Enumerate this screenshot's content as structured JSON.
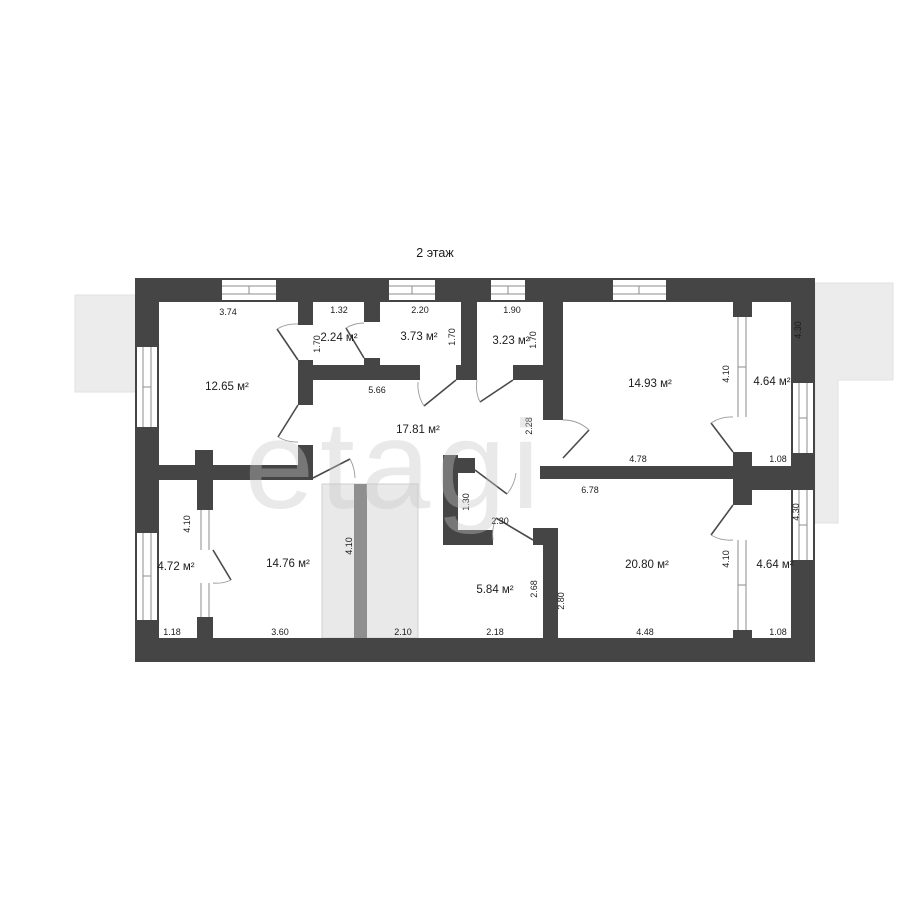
{
  "page": {
    "title": "2 этаж",
    "watermark": "etagi"
  },
  "colors": {
    "background": "#ffffff",
    "wall": "#454545",
    "outside_area": "#ececec",
    "stairs_fill": "#e9e9e9",
    "stairs_band": "#8f8f8f",
    "window_line": "#8c8c8c",
    "door_line": "#4a4a4a",
    "arc_line": "#9a9a9a",
    "label_text": "#1c1c1c",
    "watermark_color": "#c8c8c8"
  },
  "rooms": [
    {
      "id": "room-12-65",
      "area_label": "12.65 м²"
    },
    {
      "id": "room-2-24",
      "area_label": "2.24 м²"
    },
    {
      "id": "room-3-73",
      "area_label": "3.73 м²"
    },
    {
      "id": "room-3-23",
      "area_label": "3.23 м²"
    },
    {
      "id": "room-14-93",
      "area_label": "14.93 м²"
    },
    {
      "id": "room-4-64-upper",
      "area_label": "4.64 м²"
    },
    {
      "id": "room-17-81",
      "area_label": "17.81 м²"
    },
    {
      "id": "room-4-72",
      "area_label": "4.72 м²"
    },
    {
      "id": "room-14-76",
      "area_label": "14.76 м²"
    },
    {
      "id": "room-5-84",
      "area_label": "5.84 м²"
    },
    {
      "id": "room-20-80",
      "area_label": "20.80 м²"
    },
    {
      "id": "room-4-64-lower",
      "area_label": "4.64 м²"
    }
  ],
  "dimensions_horizontal": [
    {
      "value": "3.74"
    },
    {
      "value": "1.32"
    },
    {
      "value": "2.20"
    },
    {
      "value": "1.90"
    },
    {
      "value": "5.66"
    },
    {
      "value": "4.78"
    },
    {
      "value": "1.08"
    },
    {
      "value": "6.78"
    },
    {
      "value": "2.30"
    },
    {
      "value": "1.18"
    },
    {
      "value": "3.60"
    },
    {
      "value": "2.10"
    },
    {
      "value": "2.18"
    },
    {
      "value": "4.48"
    },
    {
      "value": "1.08"
    }
  ],
  "dimensions_vertical": [
    {
      "value": "1.70"
    },
    {
      "value": "1.70"
    },
    {
      "value": "1.70"
    },
    {
      "value": "4.30"
    },
    {
      "value": "4.10"
    },
    {
      "value": "2.28"
    },
    {
      "value": "4.10"
    },
    {
      "value": "4.10"
    },
    {
      "value": "1.30"
    },
    {
      "value": "2.68"
    },
    {
      "value": "2.80"
    },
    {
      "value": "4.10"
    },
    {
      "value": "4.30"
    }
  ]
}
